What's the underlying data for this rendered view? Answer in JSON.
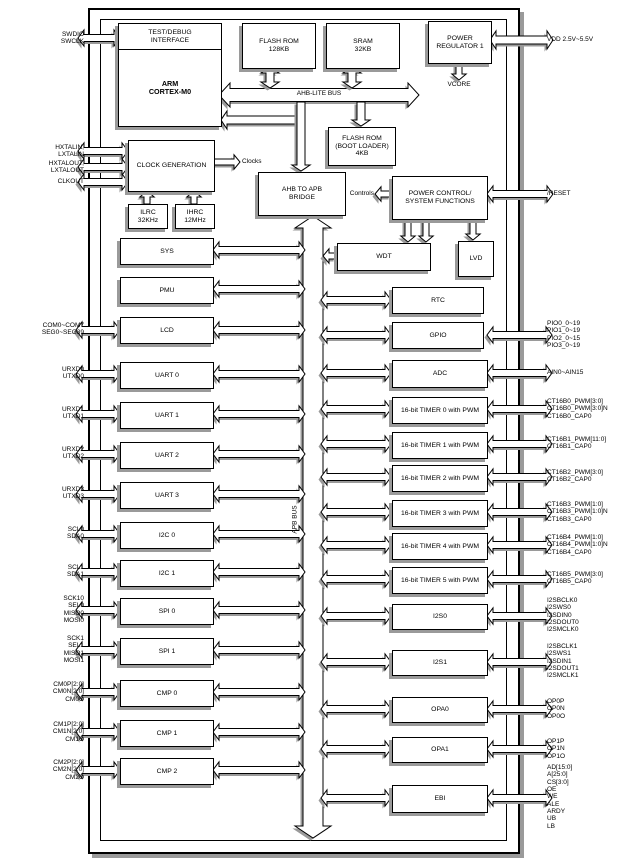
{
  "blocks": {
    "test_debug": "TEST/DEBUG\nINTERFACE",
    "arm": "ARM\nCORTEX-M0",
    "flash_rom": "FLASH ROM\n128KB",
    "sram": "SRAM\n32KB",
    "power_regulator": "POWER\nREGULATOR 1",
    "clock_generation": "CLOCK GENERATION",
    "ilrc": "ILRC\n32KHz",
    "ihrc": "IHRC\n12MHz",
    "boot_rom": "FLASH ROM\n(BOOT LOADER)\n4KB",
    "ahb_apb_bridge": "AHB TO APB\nBRIDGE",
    "power_control": "POWER CONTROL/\nSYSTEM FUNCTIONS",
    "wdt": "WDT",
    "lvd": "LVD",
    "rtc": "RTC",
    "gpio": "GPIO",
    "sys": "SYS",
    "pmu": "PMU",
    "lcd": "LCD",
    "uart0": "UART 0",
    "uart1": "UART 1",
    "uart2": "UART 2",
    "uart3": "UART 3",
    "i2c0": "I2C 0",
    "i2c1": "I2C 1",
    "spi0": "SPI 0",
    "spi1": "SPI 1",
    "cmp0": "CMP 0",
    "cmp1": "CMP 1",
    "cmp2": "CMP 2",
    "adc": "ADC",
    "timer0": "16-bit TIMER 0 with PWM",
    "timer1": "16-bit TIMER 1 with PWM",
    "timer2": "16-bit TIMER 2 with PWM",
    "timer3": "16-bit TIMER 3 with PWM",
    "timer4": "16-bit TIMER 4 with PWM",
    "timer5": "16-bit TIMER 5 with PWM",
    "i2s0": "I2S0",
    "i2s1": "I2S1",
    "opa0": "OPA0",
    "opa1": "OPA1",
    "ebi": "EBI"
  },
  "labels": {
    "ahb_bus": "AHB-LITE BUS",
    "apb_bus": "APB BUS",
    "clocks": "Clocks",
    "controls": "Controls",
    "vcore": "VCORE"
  },
  "pins_left": {
    "swd": [
      "SWDIO",
      "SWCLK"
    ],
    "xtal_in": [
      "HXTALIN,",
      "LXTALIN"
    ],
    "xtal_out": [
      "HXTALOUT,",
      "LXTALOUT"
    ],
    "clkout": [
      "CLKOUT"
    ],
    "lcd": [
      "COM0~COM7",
      "SEG0~SEG39"
    ],
    "uart0": [
      "URXD0",
      "UTXD0"
    ],
    "uart1": [
      "URXD1",
      "UTXD1"
    ],
    "uart2": [
      "URXD2",
      "UTXD2"
    ],
    "uart3": [
      "URXD3",
      "UTXD3"
    ],
    "i2c0": [
      "SCL0",
      "SDA0"
    ],
    "i2c1": [
      "SCL1",
      "SDA1"
    ],
    "spi0": [
      "SCK10",
      "SEL0",
      "MISO0",
      "MOSI0"
    ],
    "spi1": [
      "SCK1",
      "SEL1",
      "MISO1",
      "MOSI1"
    ],
    "cmp0": [
      "CM0P[2:0]",
      "CM0N[2:0]",
      "CM0O"
    ],
    "cmp1": [
      "CM1P[2:0]",
      "CM1N[2:0]",
      "CM1O"
    ],
    "cmp2": [
      "CM2P[2:0]",
      "CM2N[2:0]",
      "CM2O"
    ]
  },
  "pins_right": {
    "vdd": [
      "VDD 2.5V~5.5V"
    ],
    "reset": [
      "/RESET"
    ],
    "gpio": [
      "PIO0_0~19",
      "PIO1_0~19",
      "PIO2_0~15",
      "PIO3_0~19"
    ],
    "adc": [
      "AIN0~AIN15"
    ],
    "timer0": [
      "CT16B0_PWM[3:0]",
      "CT16B0_PWM[3:0]N",
      "CT16B0_CAP0"
    ],
    "timer1": [
      "CT16B1_PWM[11:0]",
      "CT16B1_CAP0"
    ],
    "timer2": [
      "CT16B2_PWM[3:0]",
      "CT16B2_CAP0"
    ],
    "timer3": [
      "CT16B3_PWM[1:0]",
      "CT16B3_PWM[1:0]N",
      "CT16B3_CAP0"
    ],
    "timer4": [
      "CT16B4_PWM[1:0]",
      "CT16B4_PWM[1:0]N",
      "CT16B4_CAP0"
    ],
    "timer5": [
      "CT16B5_PWM[3:0]",
      "CT16B5_CAP0"
    ],
    "i2s0": [
      "I2SBCLK0",
      "I2SWS0",
      "I2SDIN0",
      "I2SDOUT0",
      "I2SMCLK0"
    ],
    "i2s1": [
      "I2SBCLK1",
      "I2SWS1",
      "I2SDIN1",
      "I2SDOUT1",
      "I2SMCLK1"
    ],
    "opa0": [
      "OP0P",
      "OP0N",
      "OP0O"
    ],
    "opa1": [
      "OP1P",
      "OP1N",
      "OP1O"
    ],
    "ebi": [
      "AD[15:0]",
      "A[25:0]",
      "CS[3:0]",
      "OE",
      "WE",
      "ALE",
      "ARDY",
      "UB",
      "LB"
    ]
  },
  "colors": {
    "line": "#000000",
    "shadow": "#9a9a9a",
    "background": "#ffffff"
  }
}
